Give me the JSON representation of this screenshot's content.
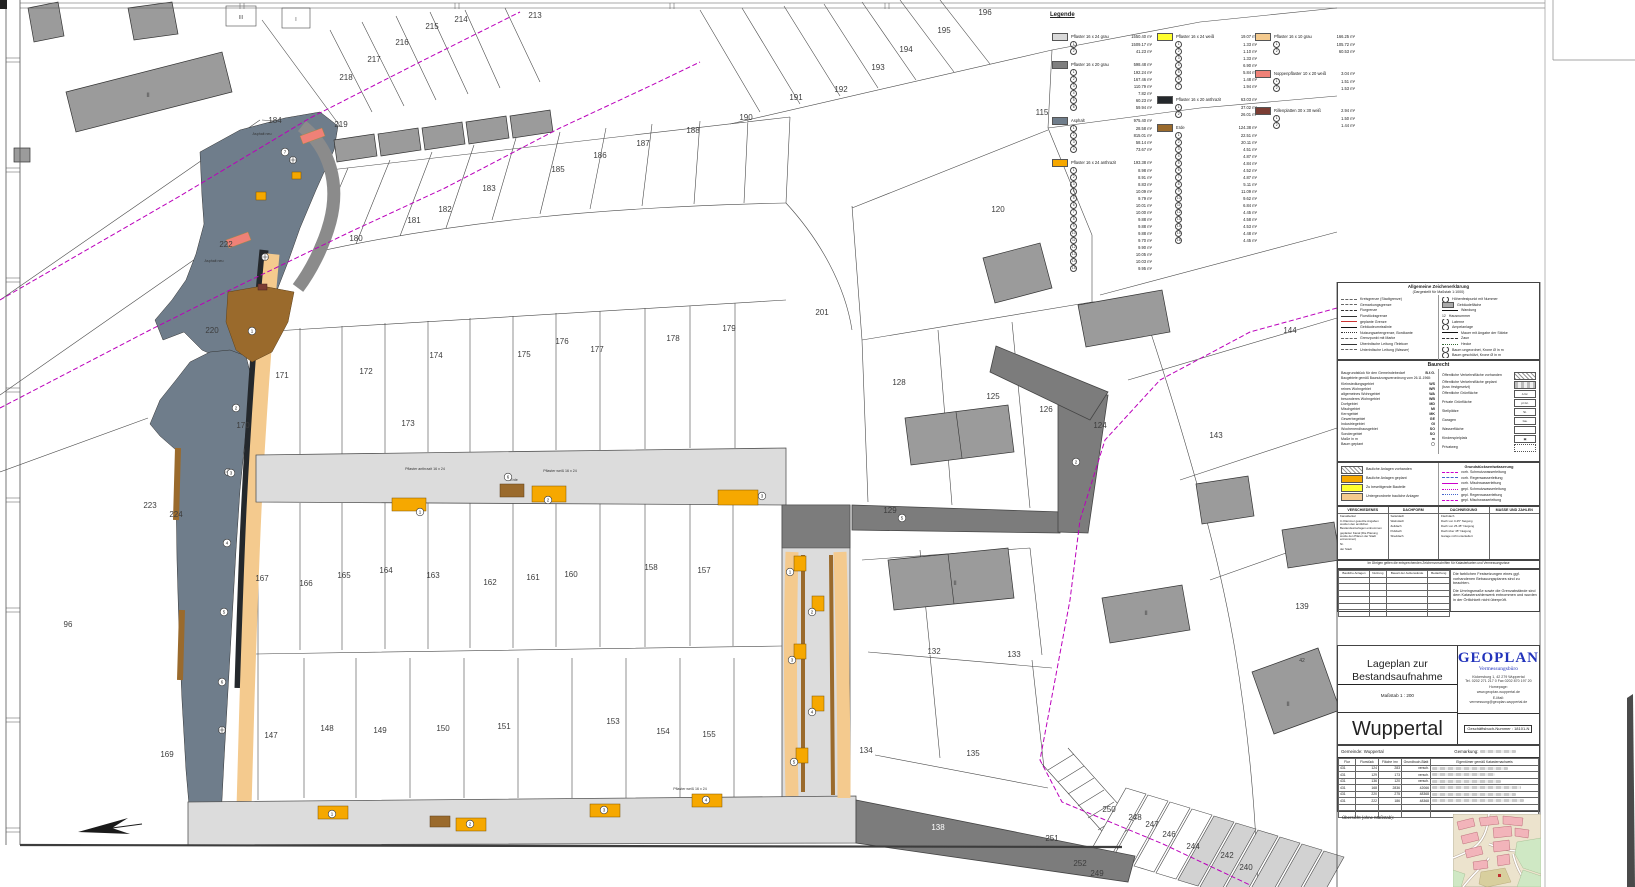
{
  "legend": {
    "title": "Legende",
    "groups": [
      {
        "col": 0,
        "color": "#d9d9d9",
        "label": "Pflaster 16 x 24 grau",
        "total": "1550.40 m²",
        "items": [
          "1509.17 m²",
          "41.23 m²"
        ]
      },
      {
        "col": 0,
        "color": "#7f7f7f",
        "label": "Pflaster 16 x 20 grau",
        "total": "598.48 m²",
        "items": [
          "192.24 m²",
          "167.46 m²",
          "110.79 m²",
          "7.82 m²",
          "60.23 m²",
          "59.94 m²"
        ]
      },
      {
        "col": 0,
        "color": "#6f7d8b",
        "label": "Asphalt",
        "total": "975.40 m²",
        "items": [
          "28.58 m²",
          "815.01 m²",
          "58.14 m²",
          "73.67 m²"
        ]
      },
      {
        "col": 0,
        "color": "#f6a800",
        "label": "Pflaster 16 x 24 anthrazit",
        "total": "193.38 m²",
        "items": [
          "8.98 m²",
          "8.91 m²",
          "8.83 m²",
          "10.09 m²",
          "9.79 m²",
          "10.01 m²",
          "10.00 m²",
          "9.88 m²",
          "9.88 m²",
          "9.88 m²",
          "9.70 m²",
          "9.90 m²",
          "10.05 m²",
          "10.03 m²",
          "9.95 m²"
        ]
      },
      {
        "col": 1,
        "color": "#ffff2e",
        "label": "Pflaster 16 x 24 weiß",
        "total": "19.07 m²",
        "items": [
          "1.33 m²",
          "1.10 m²",
          "1.33 m²",
          "6.90 m²",
          "5.84 m²",
          "1.48 m²",
          "1.94 m²"
        ]
      },
      {
        "col": 1,
        "color": "#24282c",
        "label": "Pflaster 16 x 20 anthrazit",
        "total": "63.03 m²",
        "items": [
          "37.02 m²",
          "26.01 m²"
        ]
      },
      {
        "col": 1,
        "color": "#9a6a2c",
        "label": "Erde",
        "total": "124.38 m²",
        "items": [
          "22.51 m²",
          "20.11 m²",
          "4.51 m²",
          "4.87 m²",
          "4.84 m²",
          "4.52 m²",
          "4.87 m²",
          "5.11 m²",
          "11.09 m²",
          "9.62 m²",
          "6.84 m²",
          "4.45 m²",
          "4.58 m²",
          "4.53 m²",
          "4.48 m²",
          "4.45 m²"
        ]
      },
      {
        "col": 2,
        "color": "#f4ca8e",
        "label": "Pflaster 16 x 10 grau",
        "total": "166.25 m²",
        "items": [
          "105.72 m²",
          "60.53 m²"
        ]
      },
      {
        "col": 2,
        "color": "#ef8177",
        "label": "Noppenpflaster 10 x 20 weiß",
        "total": "3.04 m²",
        "items": [
          "1.51 m²",
          "1.53 m²"
        ]
      },
      {
        "col": 2,
        "color": "#7b3d33",
        "label": "Rillenplatten 30 x 30 weiß",
        "total": "2.94 m²",
        "items": [
          "1.50 m²",
          "1.44 m²"
        ]
      }
    ]
  },
  "general_key": {
    "title": "Allgemeine Zeichenerklärung",
    "subtitle": "(Dargestellt für Maßstab 1:1000)",
    "left": [
      {
        "sym": "dashdot",
        "label": "Kreisgrenze (Stadtgrenze)"
      },
      {
        "sym": "dashdot",
        "label": "Gemarkungsgrenze"
      },
      {
        "sym": "dash",
        "label": "Flurgrenze"
      },
      {
        "sym": "solid",
        "label": "Flurstücksgrenze"
      },
      {
        "sym": "red",
        "label": "geplante Grenze"
      },
      {
        "sym": "thick",
        "label": "Gebäudeumrisslinie"
      },
      {
        "sym": "dot",
        "label": "Nutzungsartengrenze, Bordkante"
      },
      {
        "sym": "dashdot",
        "label": "Grenzpunkt mit Marke"
      },
      {
        "sym": "solid",
        "label": "Überirdische Leitung /Telekom"
      },
      {
        "sym": "dashdot",
        "label": "Unterirdische Leitung (Wasser)"
      }
    ],
    "right": [
      {
        "sym": "circle",
        "label": "Höhenfestpunkt mit Nummer"
      },
      {
        "sym": "graybox",
        "label": "Gebäudefläche"
      },
      {
        "sym": "thick",
        "label": "Wandung"
      },
      {
        "sym": "num",
        "label": "Hausnummer"
      },
      {
        "sym": "circle",
        "label": "Laterne"
      },
      {
        "sym": "circle",
        "label": "Ampelanlage"
      },
      {
        "sym": "thick",
        "label": "Mauer mit Angabe der Stärke"
      },
      {
        "sym": "dash",
        "label": "Zaun"
      },
      {
        "sym": "wave",
        "label": "Hecke"
      },
      {
        "sym": "tree",
        "label": "Baum ungeordnet, Krone Ø in m"
      },
      {
        "sym": "tree",
        "label": "Baum geschützt, Krone Ø in m"
      }
    ]
  },
  "baurecht": {
    "title": "Baurecht",
    "left_intro": {
      "label": "Baugrundstück für den Gemeindebedarf",
      "abbr": "B.f.G."
    },
    "left_note": "Baugebiete gemäß Baunutzungsverordnung vom 26.11.1968:",
    "left": [
      {
        "label": "Kleinsiedlungsgebiet",
        "abbr": "WS"
      },
      {
        "label": "reines Wohngebiet",
        "abbr": "WR"
      },
      {
        "label": "allgemeines Wohngebiet",
        "abbr": "WA"
      },
      {
        "label": "besonderes Wohngebiet",
        "abbr": "WB"
      },
      {
        "label": "Dorfgebiet",
        "abbr": "MD"
      },
      {
        "label": "Mischgebiet",
        "abbr": "MI"
      },
      {
        "label": "Kerngebiet",
        "abbr": "MK"
      },
      {
        "label": "Gewerbegebiet",
        "abbr": "GE"
      },
      {
        "label": "Industriegebiet",
        "abbr": "GI"
      },
      {
        "label": "Wochenendhausgebiet",
        "abbr": "SO"
      },
      {
        "label": "Sondergebiet",
        "abbr": "SO"
      },
      {
        "label": "Maße in m",
        "abbr": "m"
      },
      {
        "label": "Baum geplant",
        "abbr": "◯"
      }
    ],
    "right": [
      {
        "label": "Öffentliche Verkehrsfläche vorhanden",
        "box": "hatch",
        "box_text": ""
      },
      {
        "label": "Öffentliche Verkehrsfläche geplant (bzw. festgesetzt)",
        "box": "bars",
        "box_text": ""
      },
      {
        "label": "Öffentliche Grünfläche",
        "box": "text",
        "box_text": "ö.Gr."
      },
      {
        "label": "Private Grünfläche",
        "box": "text",
        "box_text": "pr.Gr."
      },
      {
        "label": "Stellplätze",
        "box": "text",
        "box_text": "St."
      },
      {
        "label": "Garagen",
        "box": "text",
        "box_text": "Ga."
      },
      {
        "label": "Wasserfläche",
        "box": "plain",
        "box_text": ""
      },
      {
        "label": "Kinderspielplatz",
        "box": "text",
        "box_text": "▣"
      },
      {
        "label": "Privatweg",
        "box": "dots",
        "box_text": ""
      }
    ]
  },
  "structures": {
    "left": [
      {
        "label": "Bauliche Anlagen vorhanden",
        "box": "hatch"
      },
      {
        "label": "Bauliche Anlagen geplant",
        "box": "orange"
      },
      {
        "label": "Zu beseitigende Bauteile",
        "box": "yellow"
      },
      {
        "label": "Untergeordnete bauliche Anlagen",
        "box": "tan"
      }
    ],
    "drainage_title": "Grundstücksentwässerung",
    "drainage": [
      {
        "sym": "mag-dash",
        "label": "vorh. Schmutzwasserleitung"
      },
      {
        "sym": "blue-dash",
        "label": "vorh. Regenwasserleitung"
      },
      {
        "sym": "mag-solid",
        "label": "vorh. Mischwasserleitung"
      },
      {
        "sym": "mag-dot",
        "label": "gepl. Schmutzwasserleitung"
      },
      {
        "sym": "blue-dot",
        "label": "gepl. Regenwasserleitung"
      },
      {
        "sym": "mag-dash",
        "label": "gepl. Mischwasserleitung"
      }
    ]
  },
  "roof_table": {
    "columns": [
      {
        "title": "VERSCHIEDENES",
        "rows": [
          "Kanaldeckel",
          "In Klammer gesetzte Angaben wurden den amtlichen Bestandsunterlagen entnommen",
          "geplanter Kanal (Die Planung wurde den Plänen der Stadt entnommen)",
          "Nr.",
          "der Stadt"
        ]
      },
      {
        "title": "DACHFORM",
        "rows": [
          "Satteldach",
          "Walmdach",
          "Zeltdach",
          "Pultdach",
          "Sheddach"
        ]
      },
      {
        "title": "DACHNEIGUNG",
        "rows": [
          "Flachdach",
          "Dach von 0-25° Neigung",
          "Dach von 25-45° Neigung",
          "Dach über 45° Neigung",
          "Garage nicht unterkellert"
        ]
      },
      {
        "title": "MASSE UND ZAHLEN",
        "rows": []
      }
    ]
  },
  "note_line": "Im Übrigen gelten die entsprechenden Zeichenvorschriften für Katasterkarten und Vermessungsrisse",
  "usage_table": {
    "headers": [
      "Bauliche Anlagen",
      "Nutzung",
      "Bauart der Außenwände",
      "Bedachung"
    ]
  },
  "notes": [
    "Die farblichen Festsetzungen eines ggf. vorhandenen Bebauungsplanes sind zu beachten.",
    "Die Umringsmaße sowie die Grenzabstände sind dem Katasterzahlenwerk entnommen und wurden in der Örtlichkeit nicht überprüft."
  ],
  "title_block": {
    "title": "Lageplan zur Bestandsaufnahme",
    "scale": "Maßstab 1 : 200",
    "city": "Wuppertal",
    "firm": {
      "name": "GEOPLAN",
      "subtitle": "Vermessungsbüro",
      "address1": "Kickersburg 1, 42 279 Wuppertal",
      "address2": "Tel. 0202 271 217 0   Fax 0202 870 197 20",
      "homepage_label": "Homepage:",
      "homepage": "www.geoplan-wuppertal.de",
      "email_label": "E-Mail:",
      "email": "vermessung@geoplan-wuppertal.de"
    },
    "doc_number_label": "Geschäftsbuch-Nummer :",
    "doc_number": "18101-N"
  },
  "parcel_table": {
    "left_header": "Gemeinde: Wuppertal",
    "right_header": "Gemarkung:",
    "columns": [
      "Flur",
      "Flurstück",
      "Fläche /m²",
      "Grundbuch-Blatt",
      "Eigentümer gemäß Katasternachweis"
    ],
    "rows": [
      [
        "431",
        "124",
        "283",
        "versch."
      ],
      [
        "431",
        "129",
        "173",
        "versch."
      ],
      [
        "431",
        "136",
        "120",
        "versch."
      ],
      [
        "431",
        "168",
        "2836",
        "42066"
      ],
      [
        "431",
        "220",
        "275",
        "48368"
      ],
      [
        "431",
        "222",
        "186",
        "48368"
      ]
    ]
  },
  "overview_label": "Übersicht (ohne Maßstab):",
  "map": {
    "parcel_labels": [
      {
        "t": "96",
        "x": 68,
        "y": 627
      },
      {
        "t": "115",
        "x": 1042,
        "y": 115
      },
      {
        "t": "120",
        "x": 998,
        "y": 212
      },
      {
        "t": "124",
        "x": 1100,
        "y": 428
      },
      {
        "t": "125",
        "x": 993,
        "y": 399
      },
      {
        "t": "126",
        "x": 1046,
        "y": 412
      },
      {
        "t": "128",
        "x": 899,
        "y": 385
      },
      {
        "t": "129",
        "x": 890,
        "y": 513
      },
      {
        "t": "132",
        "x": 934,
        "y": 654
      },
      {
        "t": "133",
        "x": 1014,
        "y": 657
      },
      {
        "t": "134",
        "x": 866,
        "y": 753
      },
      {
        "t": "135",
        "x": 973,
        "y": 756
      },
      {
        "t": "138",
        "x": 938,
        "y": 830,
        "c": "#ffffff"
      },
      {
        "t": "139",
        "x": 1302,
        "y": 609
      },
      {
        "t": "143",
        "x": 1216,
        "y": 438
      },
      {
        "t": "144",
        "x": 1290,
        "y": 333
      },
      {
        "t": "147",
        "x": 271,
        "y": 738
      },
      {
        "t": "148",
        "x": 327,
        "y": 731
      },
      {
        "t": "149",
        "x": 380,
        "y": 733
      },
      {
        "t": "150",
        "x": 443,
        "y": 731
      },
      {
        "t": "151",
        "x": 504,
        "y": 729
      },
      {
        "t": "153",
        "x": 613,
        "y": 724
      },
      {
        "t": "154",
        "x": 663,
        "y": 734
      },
      {
        "t": "155",
        "x": 709,
        "y": 737
      },
      {
        "t": "157",
        "x": 704,
        "y": 573
      },
      {
        "t": "158",
        "x": 651,
        "y": 570
      },
      {
        "t": "160",
        "x": 571,
        "y": 577
      },
      {
        "t": "161",
        "x": 533,
        "y": 580
      },
      {
        "t": "162",
        "x": 490,
        "y": 585
      },
      {
        "t": "163",
        "x": 433,
        "y": 578
      },
      {
        "t": "164",
        "x": 386,
        "y": 573
      },
      {
        "t": "165",
        "x": 344,
        "y": 578
      },
      {
        "t": "166",
        "x": 306,
        "y": 586
      },
      {
        "t": "167",
        "x": 262,
        "y": 581
      },
      {
        "t": "169",
        "x": 167,
        "y": 757
      },
      {
        "t": "170",
        "x": 243,
        "y": 428
      },
      {
        "t": "171",
        "x": 282,
        "y": 378
      },
      {
        "t": "172",
        "x": 366,
        "y": 374
      },
      {
        "t": "173",
        "x": 408,
        "y": 426
      },
      {
        "t": "174",
        "x": 436,
        "y": 358
      },
      {
        "t": "175",
        "x": 524,
        "y": 357
      },
      {
        "t": "176",
        "x": 562,
        "y": 344
      },
      {
        "t": "177",
        "x": 597,
        "y": 352
      },
      {
        "t": "178",
        "x": 673,
        "y": 341
      },
      {
        "t": "179",
        "x": 729,
        "y": 331
      },
      {
        "t": "180",
        "x": 356,
        "y": 241
      },
      {
        "t": "181",
        "x": 414,
        "y": 223
      },
      {
        "t": "182",
        "x": 445,
        "y": 212
      },
      {
        "t": "183",
        "x": 489,
        "y": 191
      },
      {
        "t": "184",
        "x": 275,
        "y": 123
      },
      {
        "t": "185",
        "x": 558,
        "y": 172
      },
      {
        "t": "186",
        "x": 600,
        "y": 158
      },
      {
        "t": "187",
        "x": 643,
        "y": 146
      },
      {
        "t": "188",
        "x": 693,
        "y": 133
      },
      {
        "t": "190",
        "x": 746,
        "y": 120
      },
      {
        "t": "191",
        "x": 796,
        "y": 100
      },
      {
        "t": "192",
        "x": 841,
        "y": 92
      },
      {
        "t": "193",
        "x": 878,
        "y": 70
      },
      {
        "t": "194",
        "x": 906,
        "y": 52
      },
      {
        "t": "195",
        "x": 944,
        "y": 33
      },
      {
        "t": "196",
        "x": 985,
        "y": 15
      },
      {
        "t": "201",
        "x": 822,
        "y": 315
      },
      {
        "t": "213",
        "x": 535,
        "y": 18
      },
      {
        "t": "214",
        "x": 461,
        "y": 22
      },
      {
        "t": "215",
        "x": 432,
        "y": 29
      },
      {
        "t": "216",
        "x": 402,
        "y": 45
      },
      {
        "t": "217",
        "x": 374,
        "y": 62
      },
      {
        "t": "218",
        "x": 346,
        "y": 80
      },
      {
        "t": "219",
        "x": 341,
        "y": 127
      },
      {
        "t": "220",
        "x": 212,
        "y": 333
      },
      {
        "t": "222",
        "x": 226,
        "y": 247
      },
      {
        "t": "223",
        "x": 150,
        "y": 508
      },
      {
        "t": "224",
        "x": 176,
        "y": 517
      },
      {
        "t": "240",
        "x": 1246,
        "y": 870
      },
      {
        "t": "242",
        "x": 1227,
        "y": 858
      },
      {
        "t": "244",
        "x": 1193,
        "y": 849
      },
      {
        "t": "246",
        "x": 1169,
        "y": 837
      },
      {
        "t": "247",
        "x": 1152,
        "y": 827
      },
      {
        "t": "248",
        "x": 1135,
        "y": 820
      },
      {
        "t": "249",
        "x": 1097,
        "y": 876
      },
      {
        "t": "250",
        "x": 1109,
        "y": 812
      },
      {
        "t": "251",
        "x": 1052,
        "y": 841
      },
      {
        "t": "252",
        "x": 1080,
        "y": 866
      },
      {
        "t": "42",
        "x": 1302,
        "y": 662,
        "s": 5
      },
      {
        "t": "II",
        "x": 1288,
        "y": 706,
        "s": 6
      },
      {
        "t": "II",
        "x": 955,
        "y": 585,
        "s": 6
      },
      {
        "t": "II",
        "x": 1146,
        "y": 615,
        "s": 6
      },
      {
        "t": "II",
        "x": 148,
        "y": 97,
        "s": 6
      },
      {
        "t": "III",
        "x": 241,
        "y": 19,
        "s": 5
      },
      {
        "t": "I",
        "x": 296,
        "y": 21,
        "s": 5
      }
    ],
    "area_labels": [
      {
        "t": "Asphalt neu",
        "x": 262,
        "y": 135
      },
      {
        "t": "Asphalt neu",
        "x": 214,
        "y": 262
      },
      {
        "t": "Pflaster anthrazit 16 x 24",
        "x": 425,
        "y": 470
      },
      {
        "t": "Pflaster weiß 16 x 24",
        "x": 560,
        "y": 472
      },
      {
        "t": "Erde",
        "x": 514,
        "y": 481
      },
      {
        "t": "Pflaster weiß 16 x 24",
        "x": 690,
        "y": 790
      }
    ],
    "markers": [
      {
        "n": "1",
        "x": 420,
        "y": 512
      },
      {
        "n": "2",
        "x": 548,
        "y": 500
      },
      {
        "n": "6",
        "x": 508,
        "y": 477
      },
      {
        "n": "3",
        "x": 762,
        "y": 496
      },
      {
        "n": "1",
        "x": 252,
        "y": 331
      },
      {
        "n": "2",
        "x": 236,
        "y": 408
      },
      {
        "n": "3",
        "x": 231,
        "y": 473
      },
      {
        "n": "4",
        "x": 227,
        "y": 543
      },
      {
        "n": "5",
        "x": 224,
        "y": 612
      },
      {
        "n": "6",
        "x": 222,
        "y": 682
      },
      {
        "n": "7",
        "x": 285,
        "y": 152
      },
      {
        "n": "1",
        "x": 332,
        "y": 814
      },
      {
        "n": "2",
        "x": 470,
        "y": 824
      },
      {
        "n": "3",
        "x": 604,
        "y": 810
      },
      {
        "n": "4",
        "x": 706,
        "y": 800
      },
      {
        "n": "1",
        "x": 790,
        "y": 572
      },
      {
        "n": "2",
        "x": 812,
        "y": 612
      },
      {
        "n": "3",
        "x": 792,
        "y": 660
      },
      {
        "n": "4",
        "x": 812,
        "y": 712
      },
      {
        "n": "5",
        "x": 794,
        "y": 762
      },
      {
        "n": "5",
        "x": 902,
        "y": 518
      },
      {
        "n": "2",
        "x": 1076,
        "y": 462
      }
    ]
  },
  "colors": {
    "magenta_boundary": "#bb00bb",
    "road_light": "#dcdcdc",
    "road_dark": "#7c7c7c",
    "asphalt": "#6f7d8b",
    "tan": "#f4ca8e",
    "erde": "#9a6a2c",
    "orange": "#f6a800",
    "anthracite": "#24282c",
    "salmon": "#ef8177",
    "building_gray": "#9b9b9b",
    "geoplan_blue": "#2233bb"
  }
}
